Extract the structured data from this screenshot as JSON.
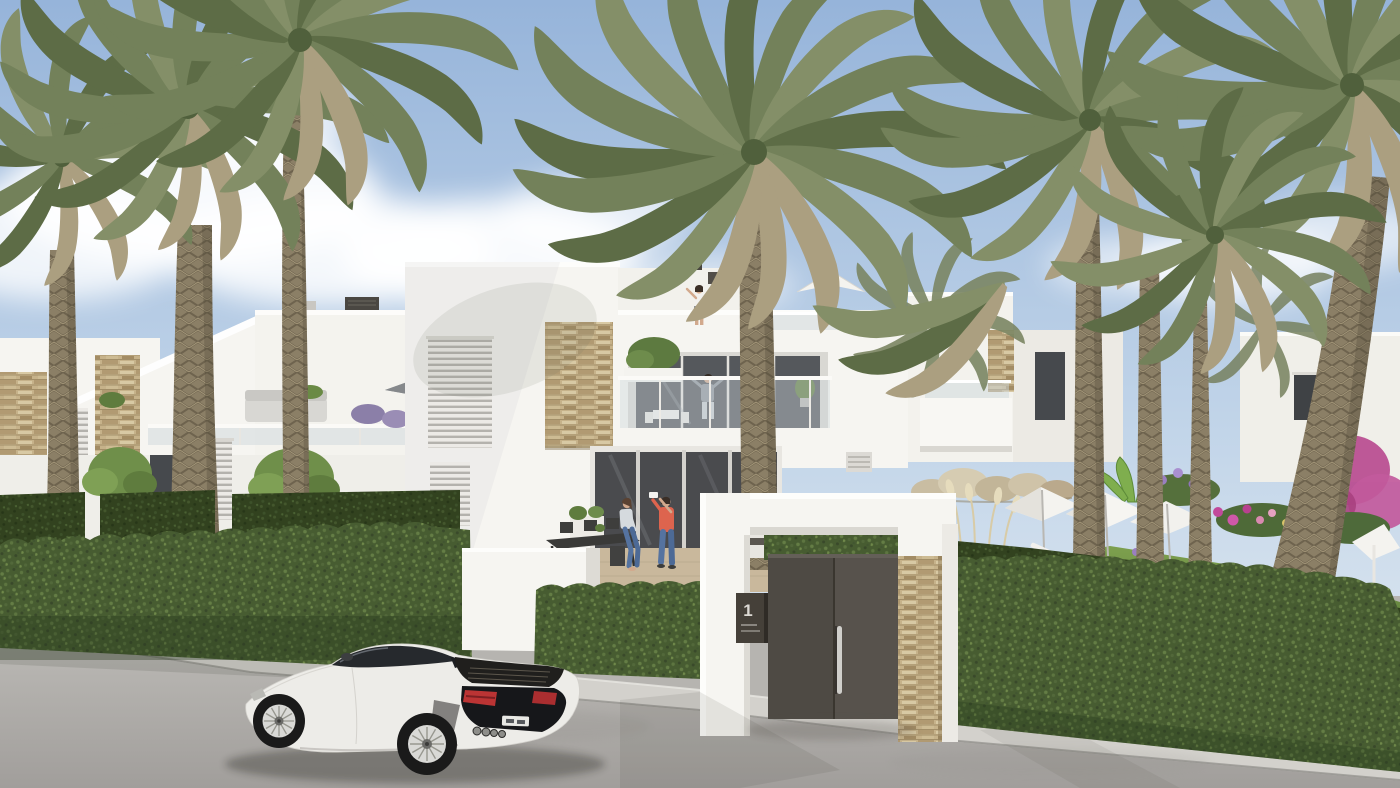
{
  "meta": {
    "description": "Photorealistic architectural rendering of a modern white Mediterranean townhouse complex with tall date palm trees, clipped green hedges, a landscaped garden with white parasols and sun loungers, a dark entrance gate marked 1, and a white sports car parked on the street",
    "people_count": 5,
    "palm_tree_count": 8,
    "parasol_count": 6,
    "vehicle_count": 1
  },
  "gate": {
    "number": "1"
  },
  "palette": {
    "sky-top": "#96b4da",
    "sky-mid": "#c2d5e9",
    "sky-low": "#e8eef3",
    "cloud": "#ffffff",
    "wall": "#f6f5f1",
    "wall-shade": "#e2e0da",
    "stone": "#c6b28a",
    "hedge": "#475c31",
    "hedge-back": "#3a4c28",
    "lawn": "#6f8f45",
    "palm-1": "#73815a",
    "palm-2": "#5d6c46",
    "palm-3": "#848f68",
    "palm-dry": "#ab9f80",
    "trunk": "#8b7f66",
    "road": "#aeacaa",
    "sidewalk": "#d3d1cc",
    "patio-floor": "#c9b89c",
    "door": "#57524c",
    "plaque": "#454039",
    "car-body": "#edece8",
    "car-glass": "#26292d",
    "taillight": "#bb3434",
    "shirt": "#dd644e",
    "jeans": "#5573a0",
    "skin": "#d2a98d",
    "window-dark": "#46494d",
    "glass": "#cdd8dc"
  }
}
